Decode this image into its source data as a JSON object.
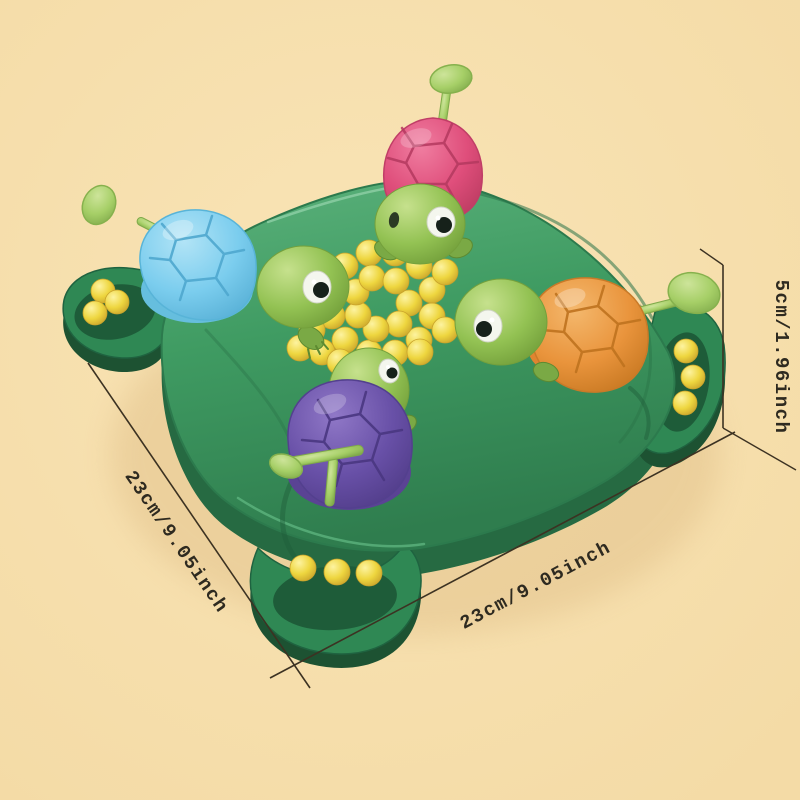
{
  "image": {
    "subject": "Hungry turtles bead-eating board game toy, four colored turtles on a green board with yellow beads",
    "annotations_present": true
  },
  "annotations": {
    "width_label": "23cm/9.05inch",
    "depth_label": "23cm/9.05inch",
    "height_label": "5cm/1.96inch"
  },
  "beads": {
    "center_count": 28,
    "left_tray_count": 3,
    "right_tray_count": 3,
    "bottom_tray_count": 3
  },
  "turtles": [
    {
      "position": "top",
      "shell": "pink"
    },
    {
      "position": "left",
      "shell": "blue"
    },
    {
      "position": "right",
      "shell": "orange"
    },
    {
      "position": "bottom",
      "shell": "purple"
    }
  ],
  "colors": {
    "background": "#f9e4b6",
    "background_edge": "#f4dba6",
    "dimension_line": "#3c3222",
    "dimension_text": "#2e2a20",
    "board_green": "#3f9b62",
    "board_green_light": "#5cb27c",
    "board_green_dark": "#266a42",
    "tray_inner_green": "#1e5c39",
    "turtle_head_green": "#93c253",
    "shell_pink": "#df4e7b",
    "shell_blue": "#7bcdee",
    "shell_orange": "#e9943c",
    "shell_purple": "#6850a7",
    "bead_yellow": "#eed63f",
    "lever_green": "#a6cf67"
  }
}
